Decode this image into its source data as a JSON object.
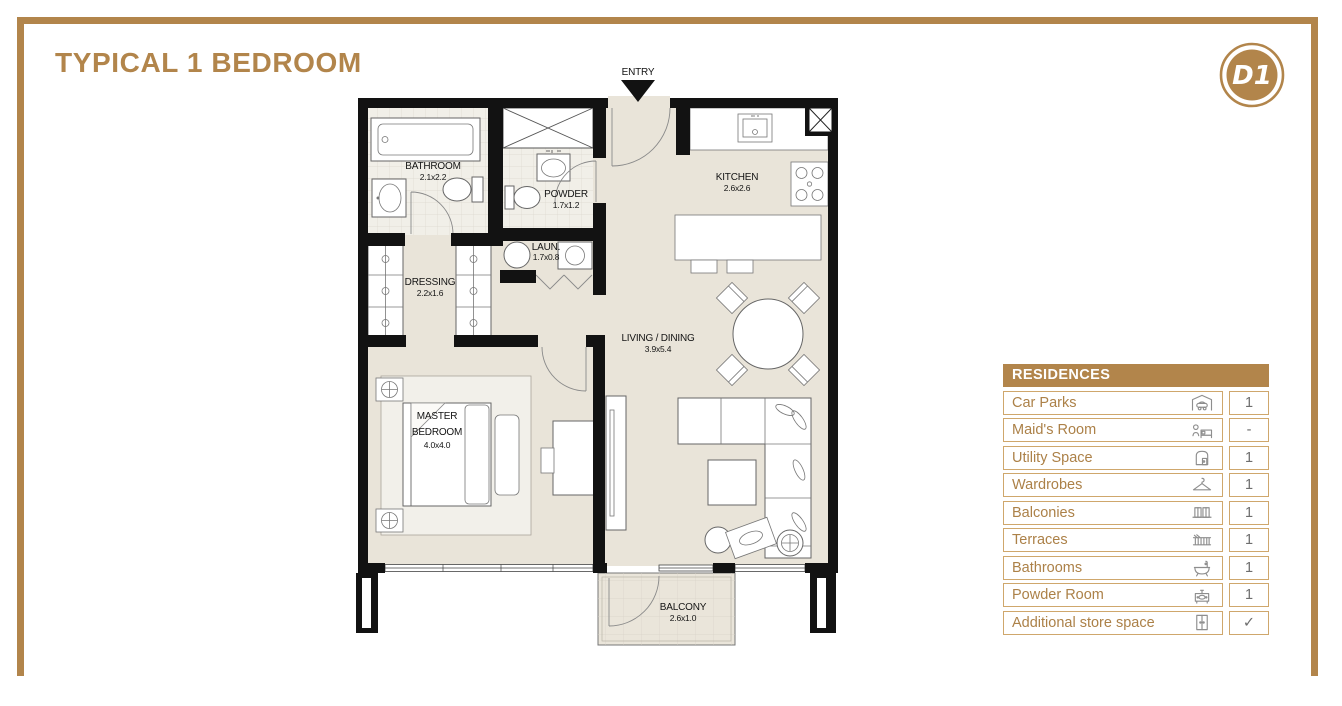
{
  "page": {
    "title": "TYPICAL 1 BEDROOM"
  },
  "logo": {
    "monogram": "D1"
  },
  "colors": {
    "accent_gold": "#b2854b",
    "table_border_gold": "#cfa76c",
    "wall_black": "#121212",
    "floor_beige": "#e9e4d9"
  },
  "floor_plan": {
    "entry_label": "ENTRY",
    "bathroom": {
      "name": "BATHROOM",
      "dims": "2.1x2.2"
    },
    "powder": {
      "name": "POWDER",
      "dims": "1.7x1.2"
    },
    "laundry": {
      "name": "LAUN.",
      "dims": "1.7x0.8"
    },
    "kitchen": {
      "name": "KITCHEN",
      "dims": "2.6x2.6"
    },
    "dressing": {
      "name": "DRESSING",
      "dims": "2.2x1.6"
    },
    "living_dining": {
      "name": "LIVING / DINING",
      "dims": "3.9x5.4"
    },
    "master_bedroom": {
      "name_line1": "MASTER",
      "name_line2": "BEDROOM",
      "dims": "4.0x4.0"
    },
    "balcony": {
      "name": "BALCONY",
      "dims": "2.6x1.0"
    }
  },
  "residences_table": {
    "header": "RESIDENCES",
    "rows": [
      {
        "label": "Car Parks",
        "icon": "car-park-icon",
        "value": "1"
      },
      {
        "label": "Maid's Room",
        "icon": "maid-room-icon",
        "value": "-"
      },
      {
        "label": "Utility Space",
        "icon": "utility-space-icon",
        "value": "1"
      },
      {
        "label": "Wardrobes",
        "icon": "hanger-icon",
        "value": "1"
      },
      {
        "label": "Balconies",
        "icon": "balcony-icon",
        "value": "1"
      },
      {
        "label": "Terraces",
        "icon": "terrace-icon",
        "value": "1"
      },
      {
        "label": "Bathrooms",
        "icon": "bathtub-icon",
        "value": "1"
      },
      {
        "label": "Powder Room",
        "icon": "vanity-icon",
        "value": "1"
      },
      {
        "label": "Additional store space",
        "icon": "store-cabinet-icon",
        "value": "✓"
      }
    ]
  }
}
